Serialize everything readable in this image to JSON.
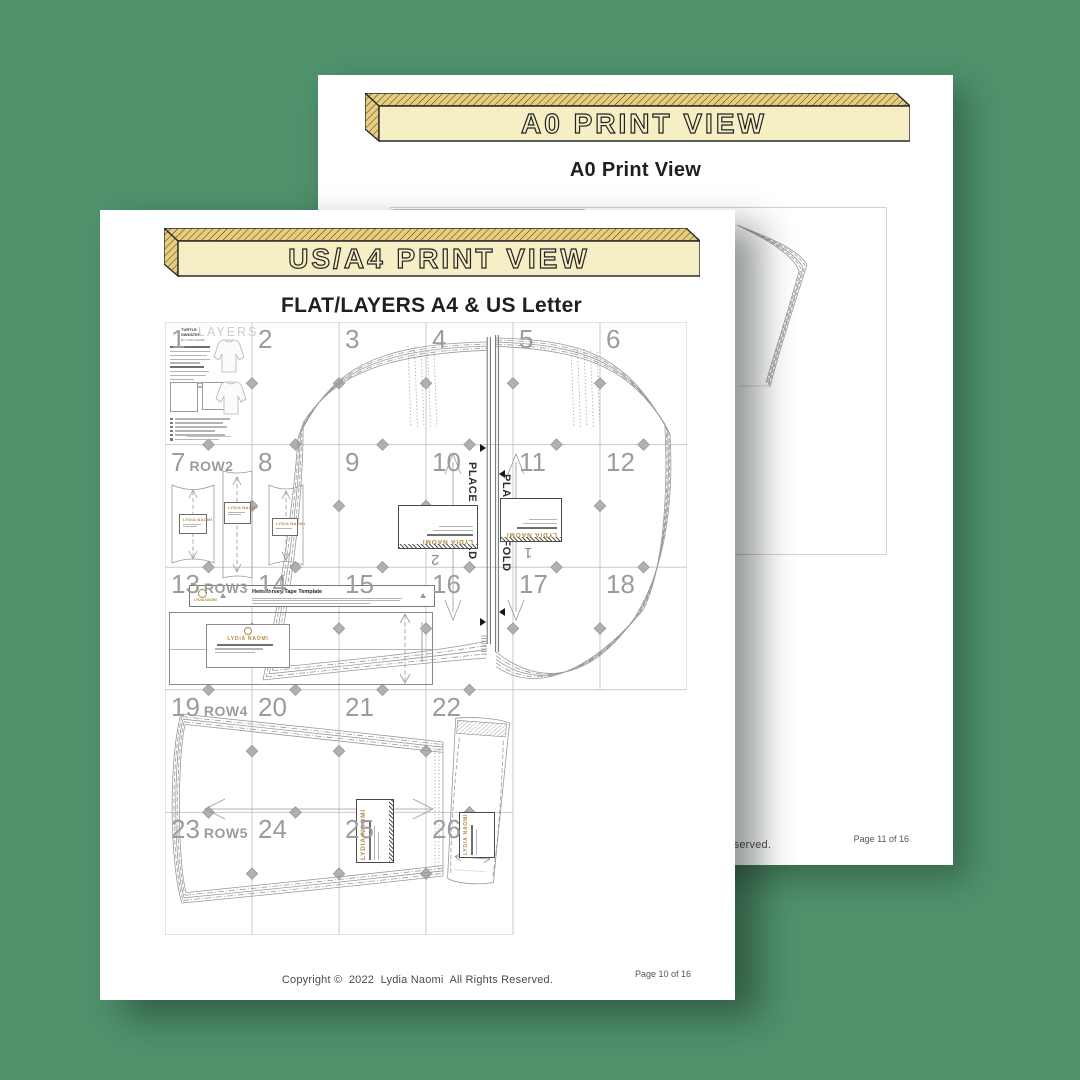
{
  "colors": {
    "background": "#4f926c",
    "banner_face": "#f6eec5",
    "banner_side": "#e7cd7d",
    "banner_outline": "#2b2b2b",
    "accent_gold": "#b08a3e",
    "grid_line": "#c9c9c9",
    "tile_number": "#9c9c9c",
    "pattern_stroke": "#9a9a9a"
  },
  "back_page": {
    "banner_label": "A0 PRINT VIEW",
    "title": "A0 Print View",
    "footer_copyright": "Copyright ©  2022  Lydia Naomi  All Rights Reserved.",
    "page_number": "Page 11 of 16"
  },
  "front_page": {
    "banner_label": "US/A4 PRINT VIEW",
    "title": "FLAT/LAYERS A4 & US Letter",
    "footer_copyright": "Copyright ©  2022  Lydia Naomi  All Rights Reserved.",
    "page_number": "Page 10 of 16",
    "grid": {
      "rows": [
        {
          "tiles": [
            "1",
            "2",
            "3",
            "4",
            "5",
            "6"
          ],
          "row_label": ""
        },
        {
          "tiles": [
            "7",
            "8",
            "9",
            "10",
            "11",
            "12"
          ],
          "row_label": "ROW2"
        },
        {
          "tiles": [
            "13",
            "14",
            "15",
            "16",
            "17",
            "18"
          ],
          "row_label": "ROW3"
        },
        {
          "tiles": [
            "19",
            "20",
            "21",
            "22"
          ],
          "row_label": "ROW4"
        },
        {
          "tiles": [
            "23",
            "24",
            "25",
            "26"
          ],
          "row_label": "ROW5"
        }
      ]
    },
    "tile1_panel": {
      "brand_line1": "TURTLE SWEATER",
      "brand_line2": "BY LYDIA NAOMI",
      "heading": "LAYERS"
    },
    "pattern": {
      "place_on_fold": "PLACE ON FOLD",
      "label_brand": "LYDIA NAOMI",
      "back_piece_number": "2",
      "front_piece_number": "1",
      "hem_template_title": "Hem Jersey Tape Template"
    }
  }
}
